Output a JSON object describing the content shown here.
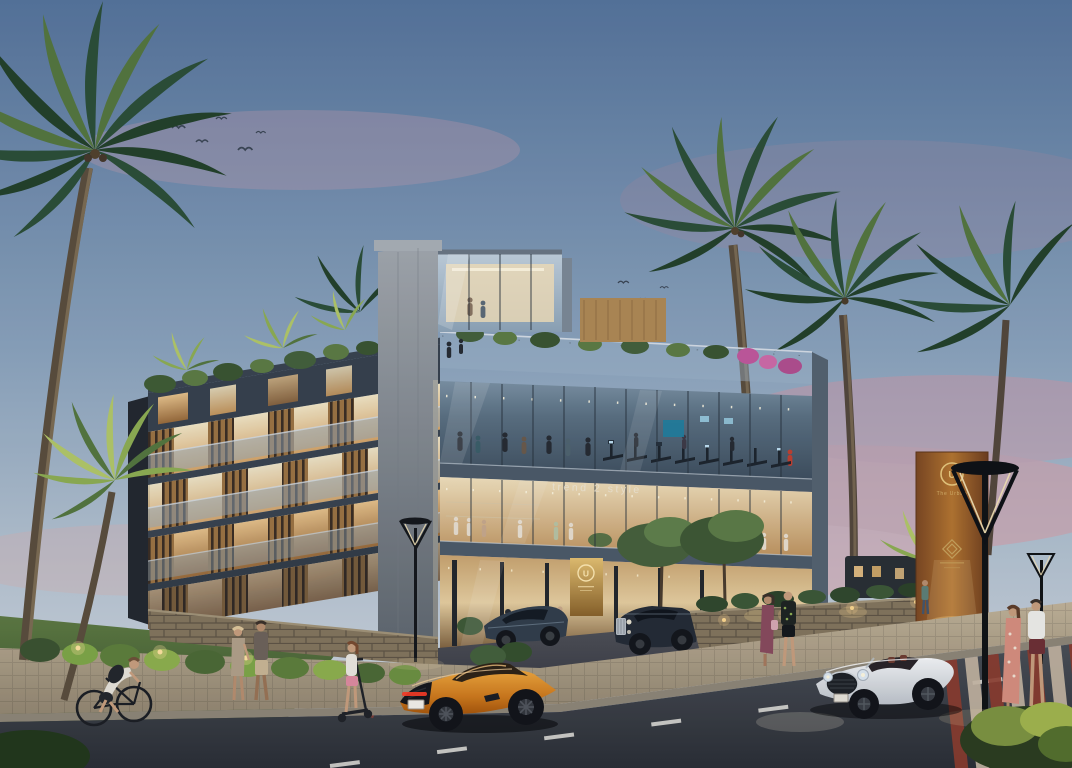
{
  "texts": {
    "storefront_sign": "trend 2 style",
    "logo_letter": "U",
    "pylon_name": "The Urban"
  },
  "palette": {
    "sky_top": "#56749b",
    "sky_mid": "#8ba3bc",
    "sky_horizon": "#d9dde2",
    "cloud_pink": "#d5a1ab",
    "palm_dark": "#2c4f36",
    "palm_lit": "#8fae52",
    "concrete": "#8d939a",
    "glass_blue": "#8aa2b8",
    "warm_glow": "#f2cf98",
    "wood_louver": "#9c7342",
    "corten_sign": "#9a5e2c",
    "gold": "#d9b36a",
    "grass": "#4f6a39",
    "road_asphalt": "#3a3f47",
    "sidewalk": "#b5a68c",
    "car_orange": "#d3851f",
    "car_white": "#e9eaec",
    "crosswalk_red": "#8e3c2d"
  }
}
